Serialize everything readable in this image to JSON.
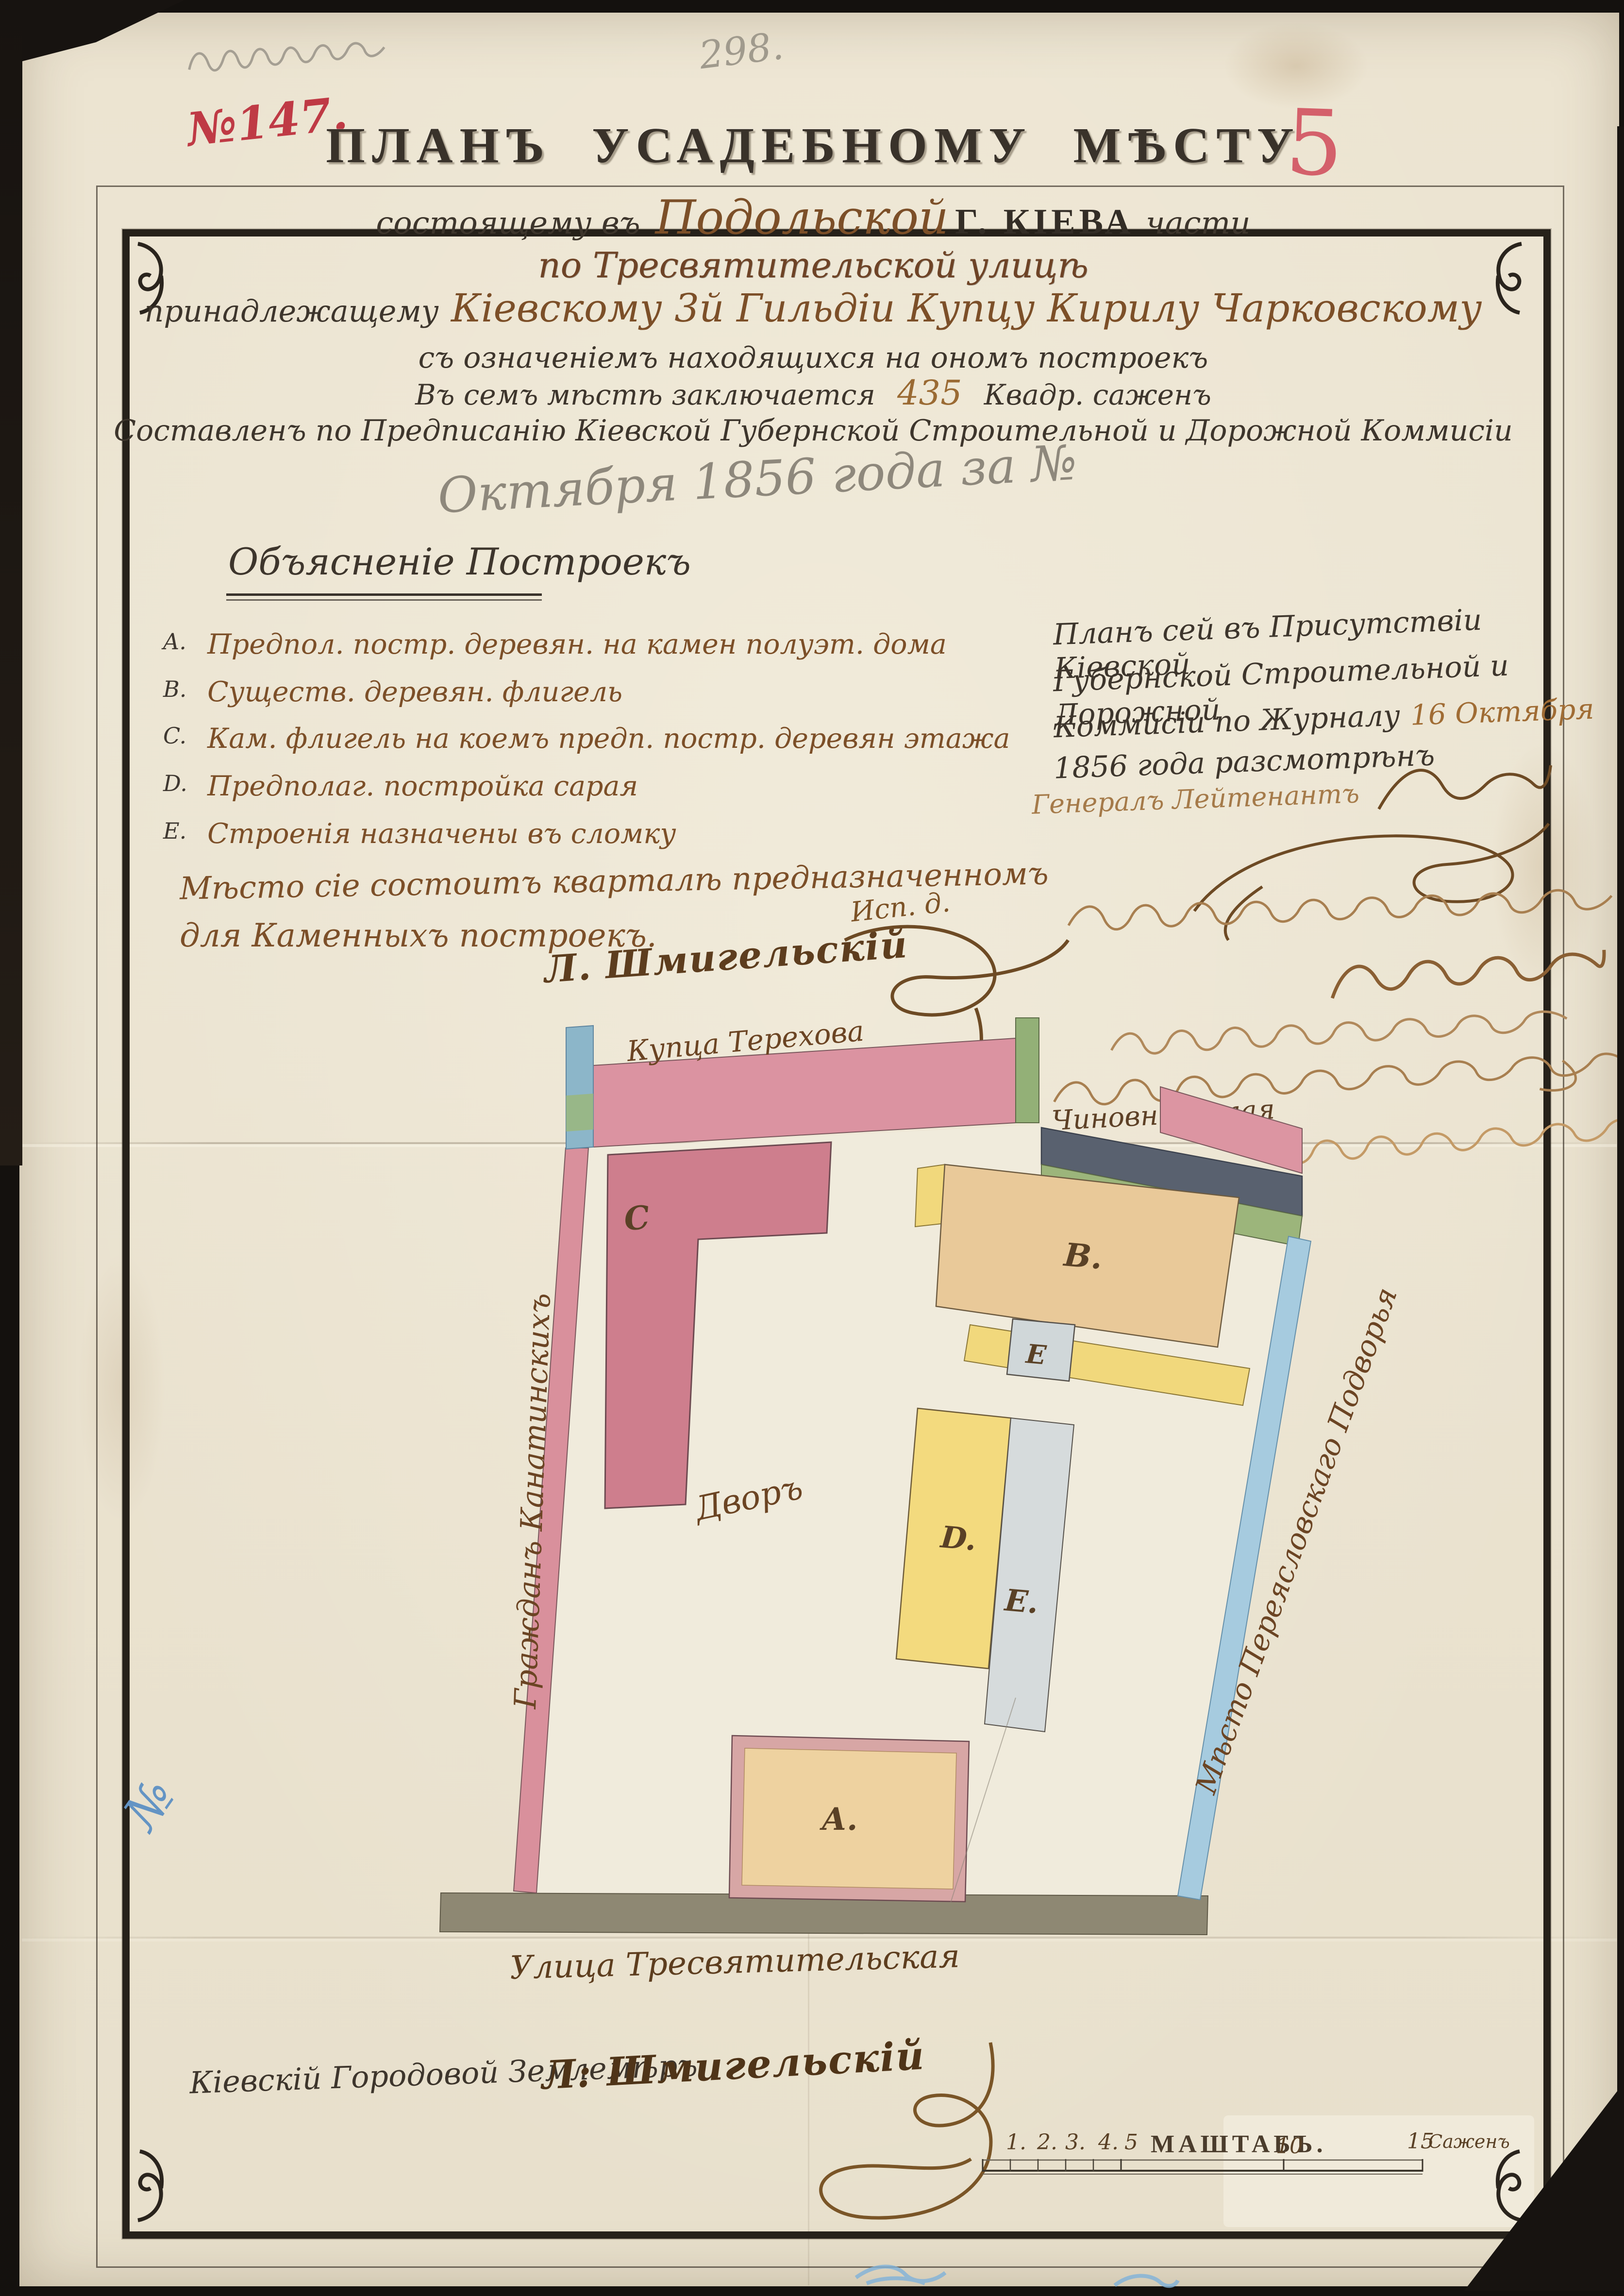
{
  "document": {
    "marks": {
      "pencil_number": "298.",
      "red_case_number": "№147.",
      "red_folio": "5",
      "blue_margin_mark": "№"
    },
    "header": {
      "title": "ПЛАНЪ УСАДЕБНОМУ МѢСТУ",
      "situated": {
        "prefix": "состоящему въ",
        "district": "Подольской",
        "city": "Г. КІЕВА",
        "suffix": "части"
      },
      "street_line": "по Тресвятительской улицѣ",
      "owner": {
        "prefix": "принадлежащему",
        "name": "Кіевскому 3й Гильдіи Купцу Кирилу Чарковскому"
      },
      "contents_line": "съ означеніемъ находящихся на ономъ построекъ",
      "area": {
        "prefix": "Въ семъ мѣстѣ заключается",
        "value": "435",
        "units": "Квадр. саженъ"
      },
      "commission_line": "Составленъ по Предписанію Кіевской Губернской Строительной и Дорожной Коммисіи",
      "date_pencil": "Октября 1856 года за №"
    },
    "legend": {
      "heading": "Объясненіе Построекъ",
      "items": [
        {
          "key": "A.",
          "text": "Предпол. постр. деревян. на камен полуэт. дома"
        },
        {
          "key": "B.",
          "text": "Существ. деревян. флигель"
        },
        {
          "key": "C.",
          "text": "Кам. флигель на коемъ предп. постр. деревян этажа"
        },
        {
          "key": "D.",
          "text": "Предполаг. постройка сарая"
        },
        {
          "key": "E.",
          "text": "Строенія назначены въ сломку"
        }
      ],
      "note_line1": "Мѣсто сіе состоитъ кварталѣ предназначенномъ",
      "note_line2": "для Каменныхъ построекъ.",
      "acting_abbrev": "Исп. д.",
      "surveyor_signature": "Л. Шмигельскій"
    },
    "approval": {
      "line1": "Планъ сей въ Присутствіи Кіевской",
      "line2": "Губернской Строительной и Дорожной",
      "line3_black": "Коммисіи по Журналу",
      "line3_date": "16 Октября",
      "line4": "1856 года разсмотрѣнъ",
      "rank": "Генералъ Лейтенантъ",
      "fragments": {
        "line1": "Чиновн. Жилая",
        "line2": "новскаго"
      }
    },
    "plan": {
      "north_label": "Купца Терехова",
      "west_label": "Гражданъ Канатинскихъ",
      "east_label": "Мѣсто Переясловскаго Подворья",
      "south_label": "Улица Тресвятительская",
      "yard_label": "Дворъ",
      "letters": {
        "a": "А.",
        "b": "B.",
        "c": "C",
        "d": "D.",
        "e_small": "Е",
        "e_strip": "E."
      }
    },
    "footer": {
      "surveyor_title": "Кіевскій Городовой Землемѣръ.",
      "surveyor_signature": "Л: Шмигельскій",
      "scale": {
        "label": "МАШТАБЪ.",
        "ticks": [
          "1.",
          "2.",
          "3.",
          "4.",
          "5"
        ],
        "mid": "10",
        "end": "15",
        "units": "Саженъ"
      }
    }
  }
}
